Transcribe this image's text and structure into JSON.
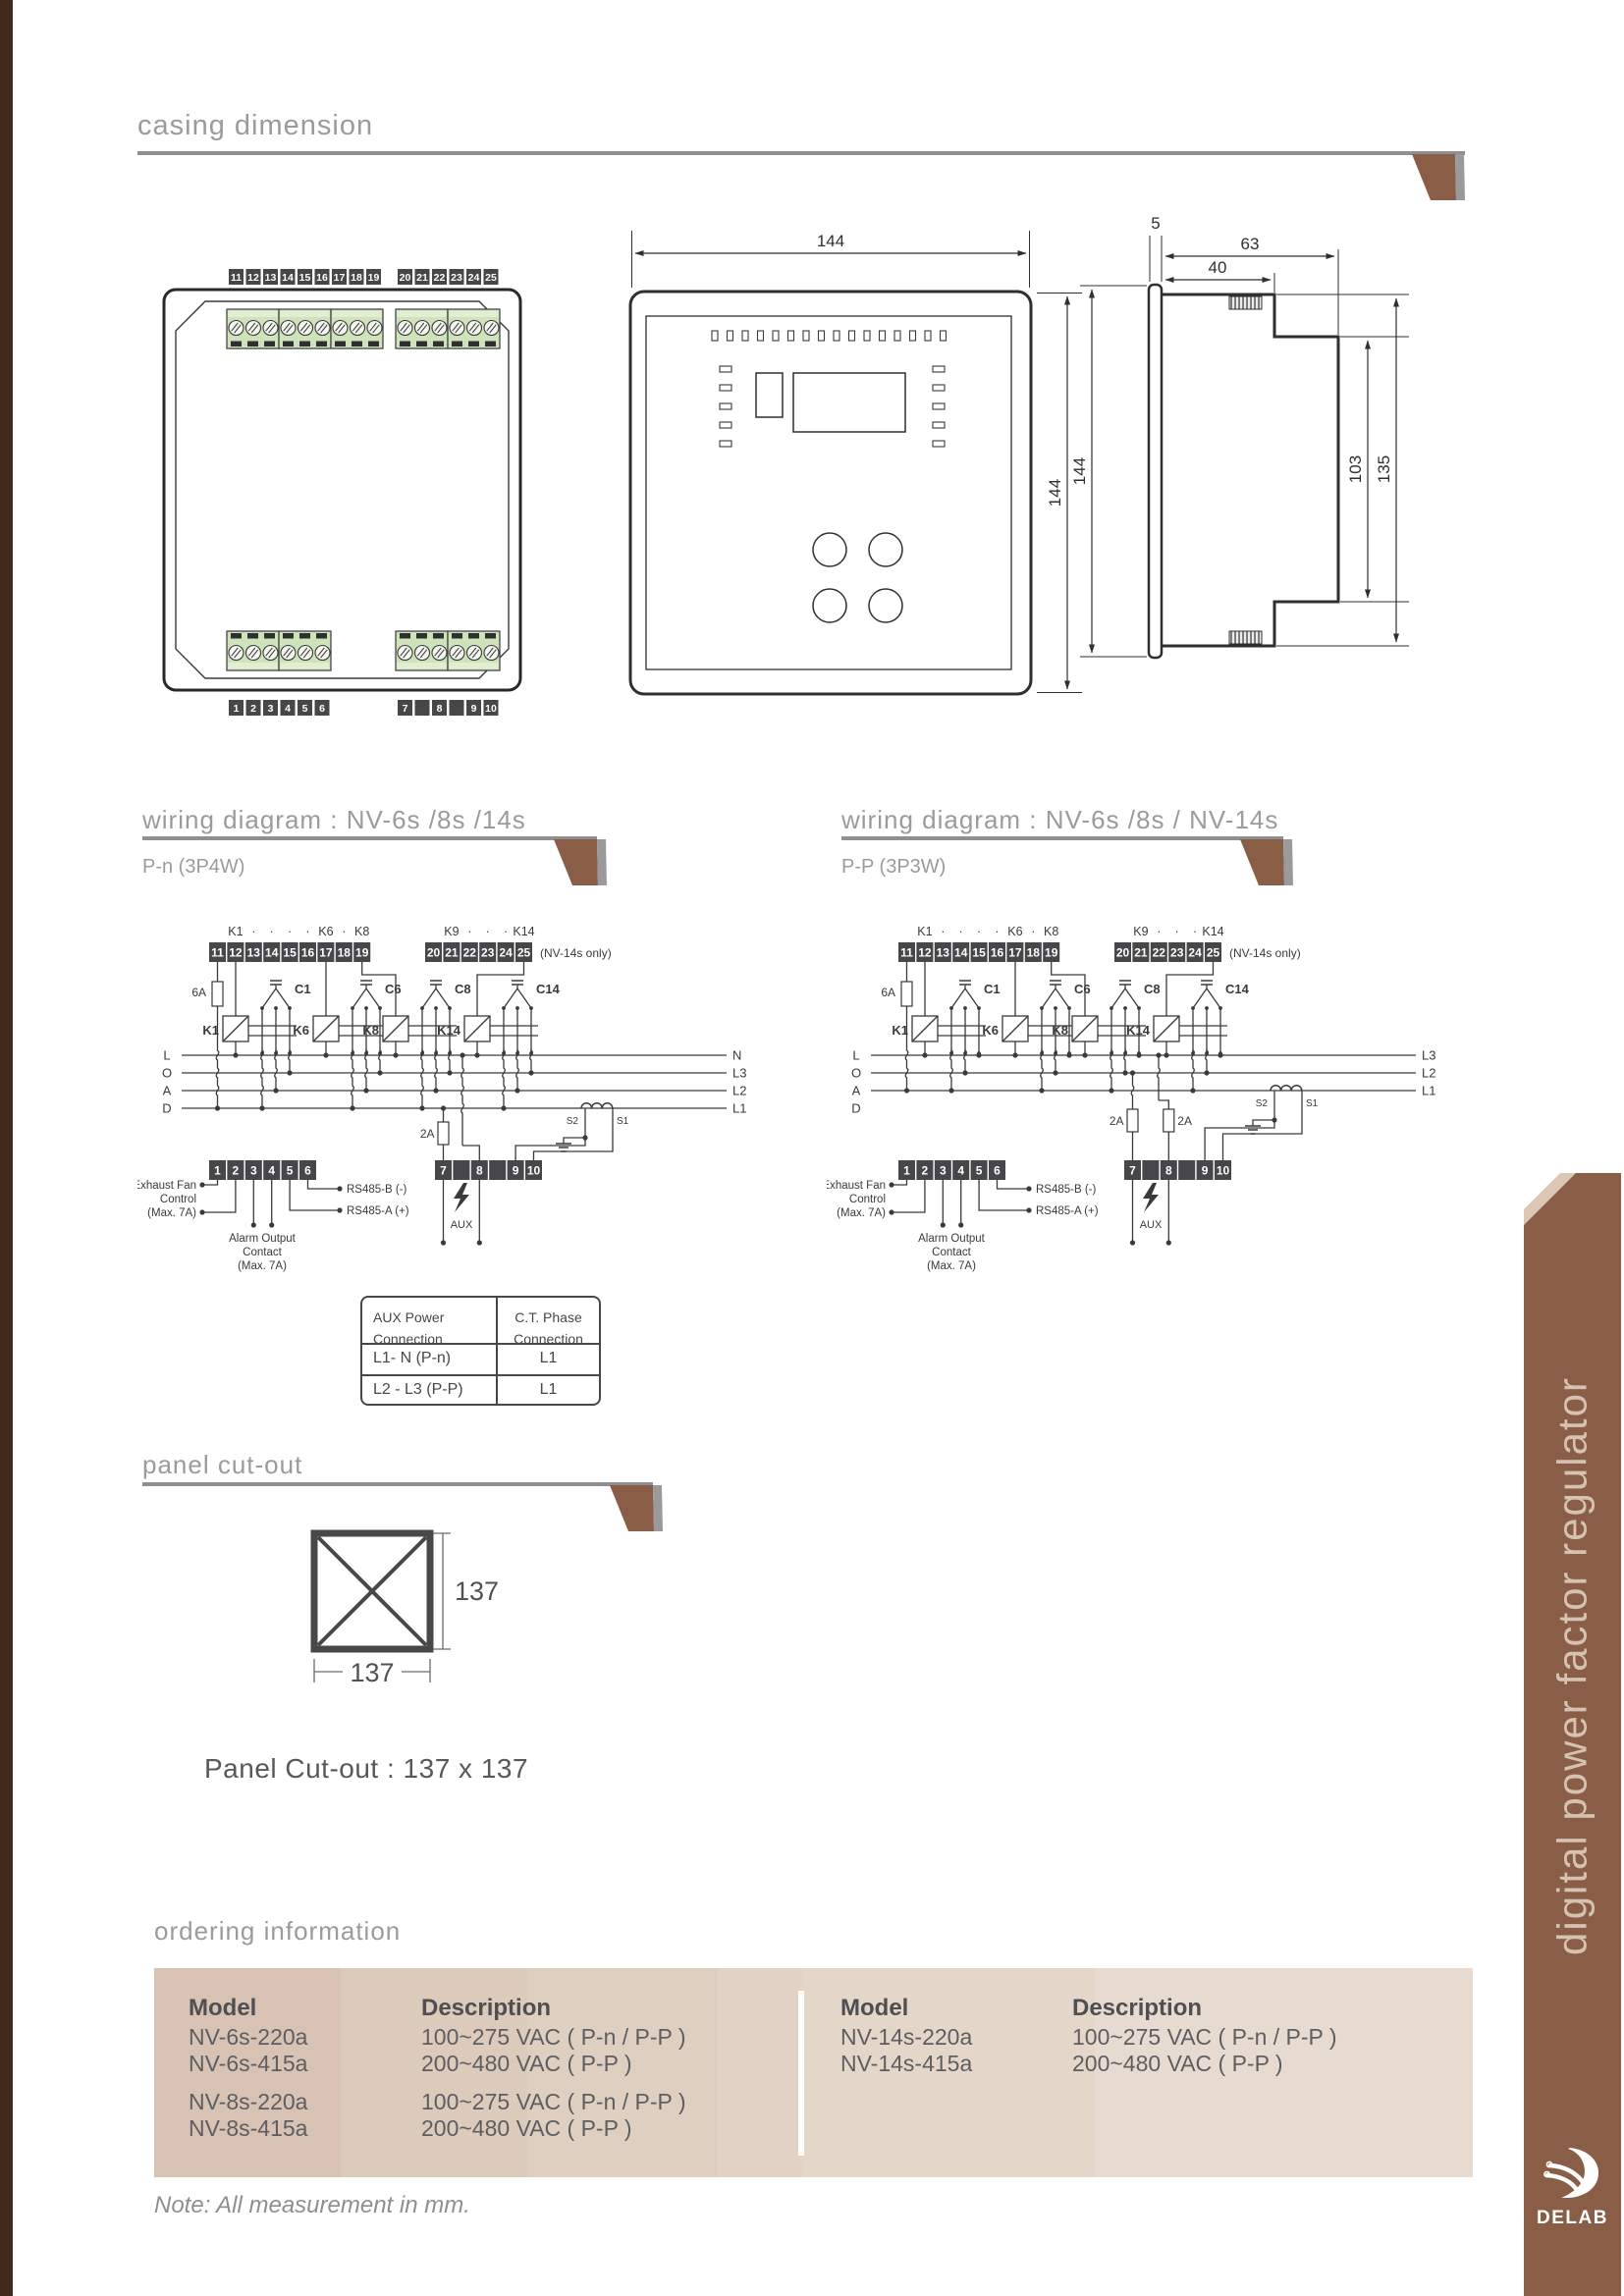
{
  "sections": {
    "casing": {
      "title": "casing dimension"
    },
    "wiring_left": {
      "title": "wiring diagram : NV-6s /8s /14s",
      "subtitle": "P-n (3P4W)"
    },
    "wiring_right": {
      "title": "wiring diagram : NV-6s /8s / NV-14s",
      "subtitle": "P-P (3P3W)"
    },
    "panel": {
      "title": "panel cut-out",
      "caption": "Panel Cut-out : 137 x 137",
      "dim_w": "137",
      "dim_h": "137"
    },
    "ordering": {
      "title": "ordering information"
    }
  },
  "casing": {
    "dims": {
      "front_w": "144",
      "front_h": "144",
      "bezel": "5",
      "depth": "63",
      "body_depth": "40",
      "inner_h": "103",
      "clip_h": "135",
      "side_h": "144"
    },
    "rear_terms": {
      "top_a": [
        "11",
        "12",
        "13",
        "14",
        "15",
        "16",
        "17",
        "18",
        "19"
      ],
      "top_b": [
        "20",
        "21",
        "22",
        "23",
        "24",
        "25"
      ],
      "bot_a": [
        "1",
        "2",
        "3",
        "4",
        "5",
        "6"
      ],
      "bot_b": [
        "7",
        "",
        "8",
        "",
        "9",
        "10"
      ]
    }
  },
  "wiring": {
    "left": {
      "variant": "pn",
      "k_row_a": [
        "K1",
        "·",
        "·",
        "·",
        "·",
        "K6",
        "·",
        "K8"
      ],
      "k_row_b": [
        "K9",
        "·",
        "·",
        "·",
        "K14"
      ],
      "top_terms_a": [
        "11",
        "12",
        "13",
        "14",
        "15",
        "16",
        "17",
        "18",
        "19"
      ],
      "top_terms_b": [
        "20",
        "21",
        "22",
        "23",
        "24",
        "25"
      ],
      "bot_terms_a": [
        "1",
        "2",
        "3",
        "4",
        "5",
        "6"
      ],
      "bot_terms_b": [
        "7",
        "",
        "8",
        "",
        "9",
        "10"
      ],
      "nv14_note": "(NV-14s only)",
      "fuse_main": "6A",
      "fuse_aux": "2A",
      "load_letters": [
        "L",
        "O",
        "A",
        "D"
      ],
      "line_labels": [
        "N",
        "L3",
        "L2",
        "L1"
      ],
      "groups": [
        {
          "k": "K1",
          "c": "C1"
        },
        {
          "k": "K6",
          "c": "C6"
        },
        {
          "k": "K8",
          "c": "C8"
        },
        {
          "k": "K14",
          "c": "C14"
        }
      ],
      "ct": {
        "s2": "S2",
        "s1": "S1"
      },
      "aux": "AUX",
      "labels": {
        "exhaust": [
          "Exhaust Fan",
          "Control",
          "(Max. 7A)"
        ],
        "alarm": [
          "Alarm Output",
          "Contact",
          "(Max. 7A)"
        ],
        "rs_b": "RS485-B (-)",
        "rs_a": "RS485-A (+)"
      }
    },
    "right": {
      "variant": "pp",
      "k_row_a": [
        "K1",
        "·",
        "·",
        "·",
        "·",
        "K6",
        "·",
        "K8"
      ],
      "k_row_b": [
        "K9",
        "·",
        "·",
        "·",
        "K14"
      ],
      "top_terms_a": [
        "11",
        "12",
        "13",
        "14",
        "15",
        "16",
        "17",
        "18",
        "19"
      ],
      "top_terms_b": [
        "20",
        "21",
        "22",
        "23",
        "24",
        "25"
      ],
      "bot_terms_a": [
        "1",
        "2",
        "3",
        "4",
        "5",
        "6"
      ],
      "bot_terms_b": [
        "7",
        "",
        "8",
        "",
        "9",
        "10"
      ],
      "nv14_note": "(NV-14s only)",
      "fuse_main": "6A",
      "fuse_aux": "2A",
      "load_letters": [
        "L",
        "O",
        "A",
        "D"
      ],
      "line_labels": [
        "L3",
        "L2",
        "L1"
      ],
      "groups": [
        {
          "k": "K1",
          "c": "C1"
        },
        {
          "k": "K6",
          "c": "C6"
        },
        {
          "k": "K8",
          "c": "C8"
        },
        {
          "k": "K14",
          "c": "C14"
        }
      ],
      "ct": {
        "s2": "S2",
        "s1": "S1"
      },
      "aux": "AUX",
      "labels": {
        "exhaust": [
          "Exhaust Fan",
          "Control",
          "(Max. 7A)"
        ],
        "alarm": [
          "Alarm Output",
          "Contact",
          "(Max. 7A)"
        ],
        "rs_b": "RS485-B (-)",
        "rs_a": "RS485-A (+)"
      }
    }
  },
  "conn_table": {
    "h1": [
      "AUX Power",
      "Connection"
    ],
    "h2": [
      "C.T. Phase",
      "Connection"
    ],
    "rows": [
      [
        "L1- N (P-n)",
        "L1"
      ],
      [
        "L2 - L3 (P-P)",
        "L1"
      ]
    ]
  },
  "ordering": {
    "left": {
      "col_model": "Model",
      "col_desc": "Description",
      "g1_models": [
        "NV-6s-220a",
        "NV-6s-415a"
      ],
      "g1_desc": [
        "100~275 VAC ( P-n / P-P )",
        "200~480 VAC ( P-P )"
      ],
      "g2_models": [
        "NV-8s-220a",
        "NV-8s-415a"
      ],
      "g2_desc": [
        "100~275 VAC ( P-n / P-P )",
        "200~480 VAC ( P-P )"
      ]
    },
    "right": {
      "col_model": "Model",
      "col_desc": "Description",
      "g1_models": [
        "NV-14s-220a",
        "NV-14s-415a"
      ],
      "g1_desc": [
        "100~275 VAC ( P-n / P-P )",
        "200~480 VAC ( P-P )"
      ]
    }
  },
  "note": "Note: All measurement in mm.",
  "sidebar": {
    "vertical_text": "digital power factor regulator",
    "brand": "DELAB"
  },
  "colors": {
    "accent_brown": "#8a5e46",
    "rule_gray": "#8f8f91",
    "band_beige": "#e0d0c2",
    "terminal_green": "#cfe3bb",
    "dark_edge": "#3f2a1c"
  }
}
